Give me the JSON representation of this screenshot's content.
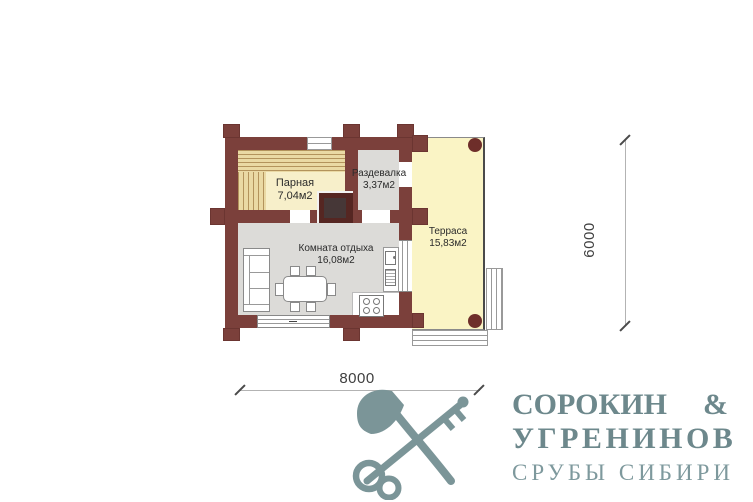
{
  "plan": {
    "rooms": {
      "parnaya": {
        "name": "Парная",
        "area": "7,04м2"
      },
      "razdevalka": {
        "name": "Раздевалка",
        "area": "3,37м2"
      },
      "komnata": {
        "name": "Комната отдыха",
        "area": "16,08м2"
      },
      "terrasa": {
        "name": "Терраса",
        "area": "15,83м2"
      }
    },
    "dimensions": {
      "horizontal": "8000",
      "vertical": "6000"
    }
  },
  "logo": {
    "icon": "axe-and-key-icon",
    "brand_top_left": "СОРОКИН",
    "brand_top_right": "&",
    "brand_bottom": "УГРЕНИНОВ",
    "tagline": "СРУБЫ СИБИРИ"
  },
  "colors": {
    "wall": "#7b403b",
    "parnaya_floor": "#f7efca",
    "bench_fill": "#ead9a4",
    "bench_line": "#b3935c",
    "room_floor": "#dcdbd8",
    "terrace_floor": "#faf4c5",
    "stove": "#552622",
    "post": "#6e2e2a",
    "logo": "#7b9598",
    "dimension_text": "#3f3f3f"
  }
}
